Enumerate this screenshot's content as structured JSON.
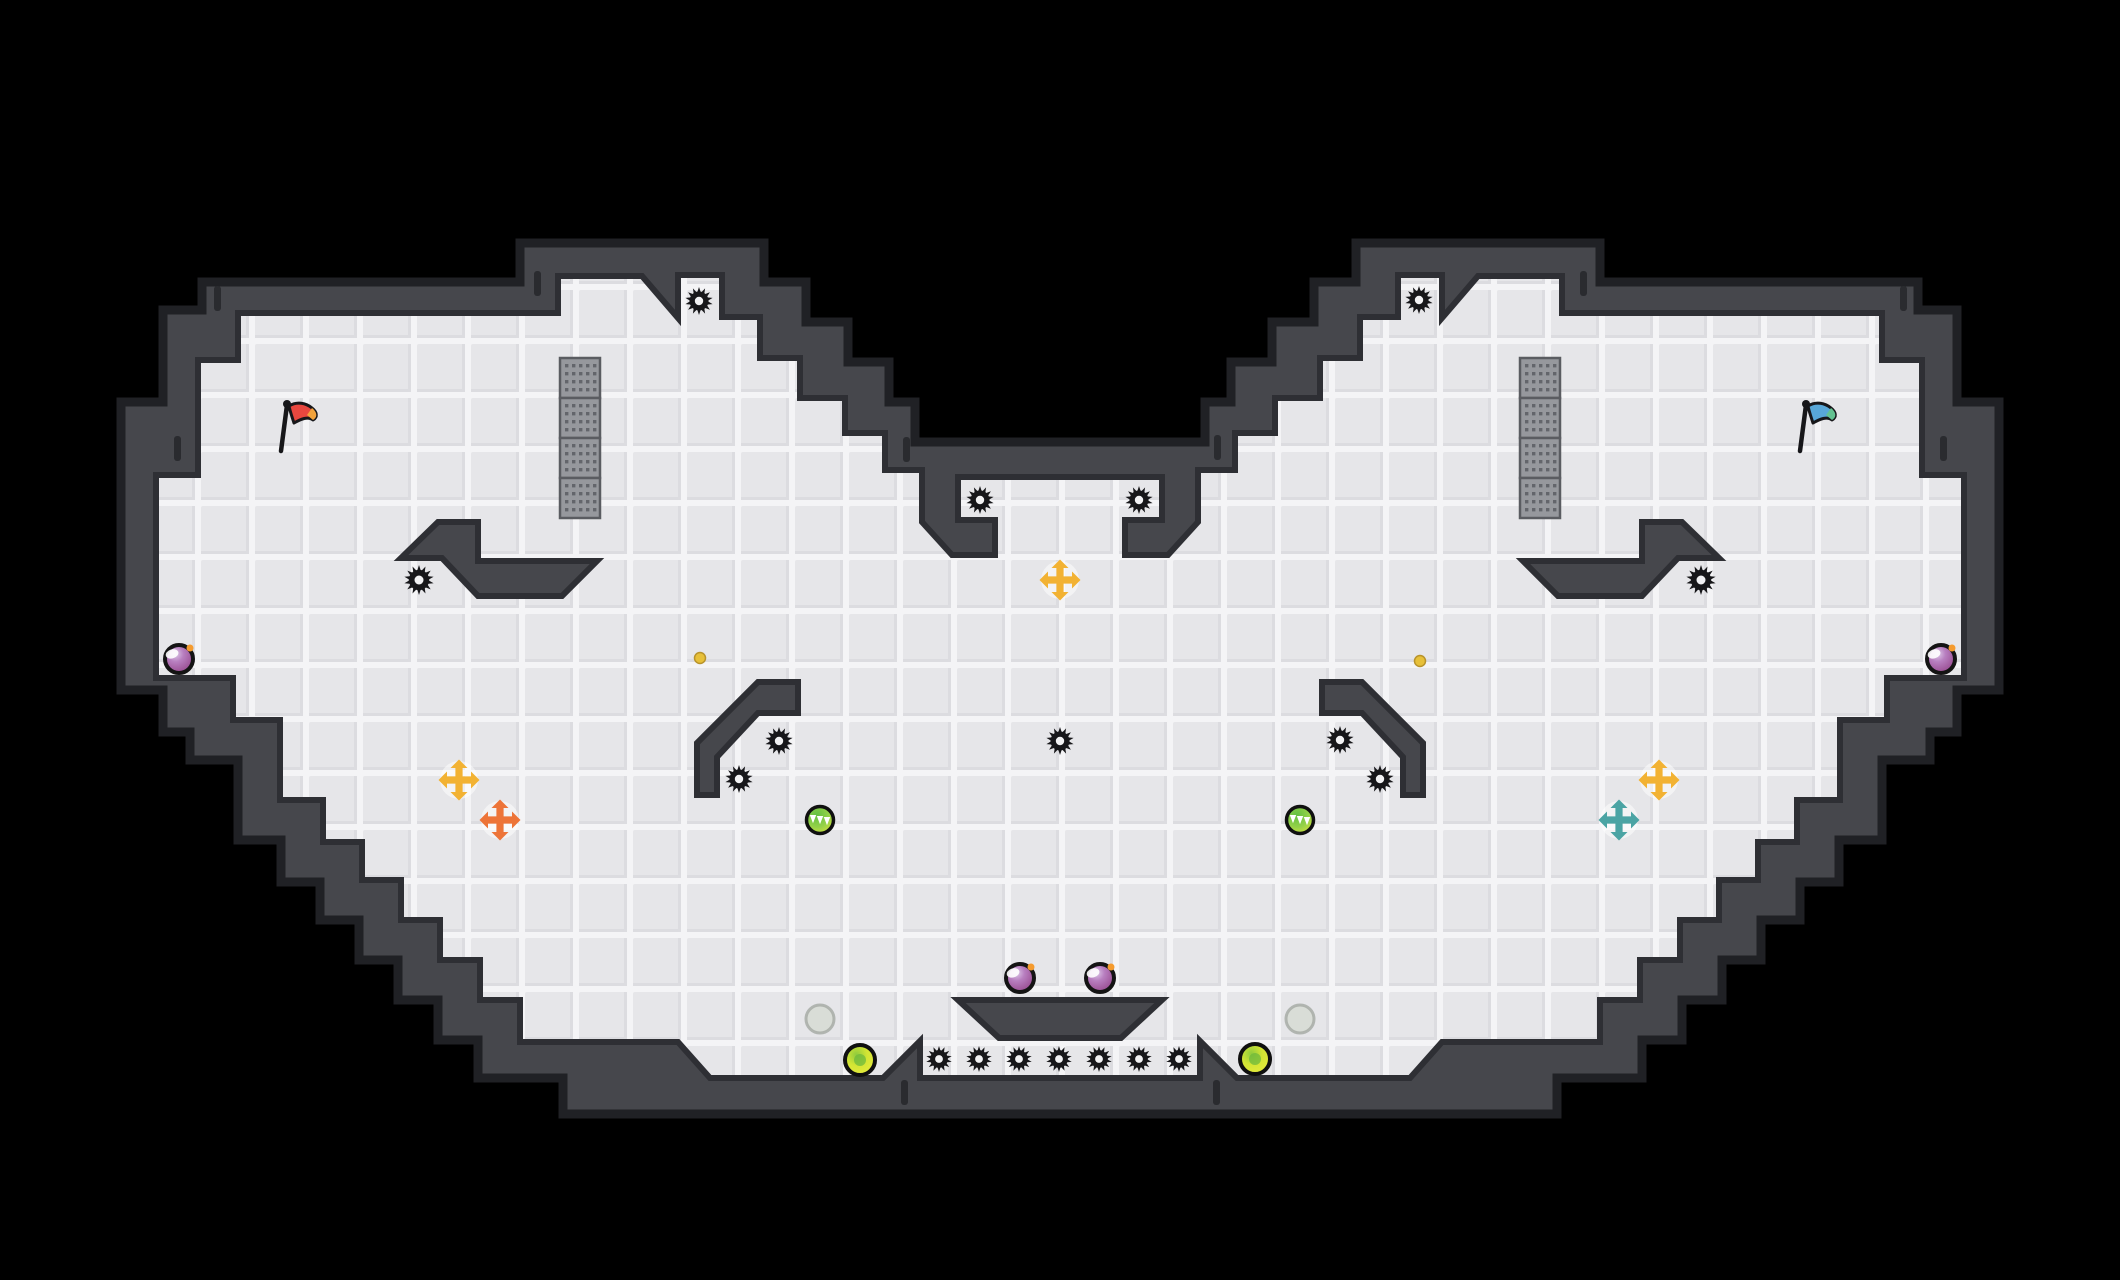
{
  "scene": {
    "width": 2120,
    "height": 1280,
    "background": "#000000"
  },
  "palette": {
    "wall": "#46474c",
    "wall_rim": "#202125",
    "wall_shadow": "#2e2f34",
    "tile": "#e6e6e9",
    "tile_groove": "#f4f4f6",
    "tile_shade": "#dcdce0",
    "gear": "#17171a",
    "gear_hole": "#f2f2f4",
    "grate_base": "#96989d",
    "grate_dot": "#63656b",
    "grate_border": "#5a5c61",
    "tick": "#2a2b2f"
  },
  "level": {
    "outer_wall_polygon": [
      [
        202,
        282
      ],
      [
        520,
        282
      ],
      [
        520,
        243
      ],
      [
        764,
        243
      ],
      [
        764,
        282
      ],
      [
        806,
        282
      ],
      [
        806,
        322
      ],
      [
        848,
        322
      ],
      [
        848,
        362
      ],
      [
        889,
        362
      ],
      [
        889,
        402
      ],
      [
        915,
        402
      ],
      [
        915,
        442
      ],
      [
        1205,
        442
      ],
      [
        1205,
        402
      ],
      [
        1231,
        402
      ],
      [
        1231,
        362
      ],
      [
        1272,
        362
      ],
      [
        1272,
        322
      ],
      [
        1314,
        322
      ],
      [
        1314,
        282
      ],
      [
        1356,
        282
      ],
      [
        1356,
        243
      ],
      [
        1600,
        243
      ],
      [
        1600,
        282
      ],
      [
        1918,
        282
      ],
      [
        1918,
        310
      ],
      [
        1957,
        310
      ],
      [
        1957,
        402
      ],
      [
        1999,
        402
      ],
      [
        1999,
        690
      ],
      [
        1957,
        690
      ],
      [
        1957,
        732
      ],
      [
        1930,
        732
      ],
      [
        1930,
        760
      ],
      [
        1882,
        760
      ],
      [
        1882,
        840
      ],
      [
        1839,
        840
      ],
      [
        1839,
        882
      ],
      [
        1800,
        882
      ],
      [
        1800,
        920
      ],
      [
        1761,
        920
      ],
      [
        1761,
        960
      ],
      [
        1722,
        960
      ],
      [
        1722,
        1000
      ],
      [
        1682,
        1000
      ],
      [
        1682,
        1040
      ],
      [
        1642,
        1040
      ],
      [
        1642,
        1078
      ],
      [
        1557,
        1078
      ],
      [
        1557,
        1114
      ],
      [
        563,
        1114
      ],
      [
        563,
        1078
      ],
      [
        478,
        1078
      ],
      [
        478,
        1040
      ],
      [
        438,
        1040
      ],
      [
        438,
        1000
      ],
      [
        398,
        1000
      ],
      [
        398,
        960
      ],
      [
        359,
        960
      ],
      [
        359,
        920
      ],
      [
        320,
        920
      ],
      [
        320,
        882
      ],
      [
        281,
        882
      ],
      [
        281,
        840
      ],
      [
        238,
        840
      ],
      [
        238,
        760
      ],
      [
        190,
        760
      ],
      [
        190,
        732
      ],
      [
        163,
        732
      ],
      [
        163,
        690
      ],
      [
        121,
        690
      ],
      [
        121,
        402
      ],
      [
        163,
        402
      ],
      [
        163,
        310
      ],
      [
        202,
        310
      ]
    ],
    "floor_polygon": [
      [
        238,
        313
      ],
      [
        558,
        313
      ],
      [
        558,
        276
      ],
      [
        642,
        276
      ],
      [
        678,
        318
      ],
      [
        678,
        275
      ],
      [
        722,
        275
      ],
      [
        722,
        317
      ],
      [
        760,
        317
      ],
      [
        760,
        358
      ],
      [
        800,
        358
      ],
      [
        800,
        398
      ],
      [
        845,
        398
      ],
      [
        845,
        433
      ],
      [
        885,
        433
      ],
      [
        885,
        470
      ],
      [
        922,
        470
      ],
      [
        922,
        522
      ],
      [
        952,
        555
      ],
      [
        995,
        555
      ],
      [
        995,
        520
      ],
      [
        958,
        520
      ],
      [
        958,
        477
      ],
      [
        1162,
        477
      ],
      [
        1162,
        520
      ],
      [
        1125,
        520
      ],
      [
        1125,
        555
      ],
      [
        1168,
        555
      ],
      [
        1198,
        522
      ],
      [
        1198,
        470
      ],
      [
        1235,
        470
      ],
      [
        1235,
        433
      ],
      [
        1275,
        433
      ],
      [
        1275,
        398
      ],
      [
        1320,
        398
      ],
      [
        1320,
        358
      ],
      [
        1360,
        358
      ],
      [
        1360,
        317
      ],
      [
        1398,
        317
      ],
      [
        1398,
        275
      ],
      [
        1442,
        275
      ],
      [
        1442,
        318
      ],
      [
        1478,
        276
      ],
      [
        1562,
        276
      ],
      [
        1562,
        313
      ],
      [
        1882,
        313
      ],
      [
        1882,
        360
      ],
      [
        1922,
        360
      ],
      [
        1922,
        475
      ],
      [
        1964,
        475
      ],
      [
        1964,
        678
      ],
      [
        1887,
        678
      ],
      [
        1887,
        720
      ],
      [
        1840,
        720
      ],
      [
        1840,
        800
      ],
      [
        1797,
        800
      ],
      [
        1797,
        842
      ],
      [
        1758,
        842
      ],
      [
        1758,
        880
      ],
      [
        1719,
        880
      ],
      [
        1719,
        920
      ],
      [
        1680,
        920
      ],
      [
        1680,
        960
      ],
      [
        1640,
        960
      ],
      [
        1640,
        1000
      ],
      [
        1600,
        1000
      ],
      [
        1600,
        1042
      ],
      [
        1442,
        1042
      ],
      [
        1410,
        1078
      ],
      [
        1237,
        1078
      ],
      [
        1200,
        1041
      ],
      [
        1200,
        1078
      ],
      [
        920,
        1078
      ],
      [
        920,
        1041
      ],
      [
        883,
        1078
      ],
      [
        710,
        1078
      ],
      [
        678,
        1042
      ],
      [
        520,
        1042
      ],
      [
        520,
        1000
      ],
      [
        480,
        1000
      ],
      [
        480,
        960
      ],
      [
        440,
        960
      ],
      [
        440,
        920
      ],
      [
        401,
        920
      ],
      [
        401,
        880
      ],
      [
        362,
        880
      ],
      [
        362,
        842
      ],
      [
        323,
        842
      ],
      [
        323,
        800
      ],
      [
        280,
        800
      ],
      [
        280,
        720
      ],
      [
        233,
        720
      ],
      [
        233,
        678
      ],
      [
        156,
        678
      ],
      [
        156,
        475
      ],
      [
        198,
        475
      ],
      [
        198,
        360
      ],
      [
        238,
        360
      ]
    ],
    "platforms": [
      {
        "name": "chevron-platform-left",
        "points": [
          [
            401,
            558
          ],
          [
            438,
            522
          ],
          [
            478,
            522
          ],
          [
            478,
            561
          ],
          [
            597,
            561
          ],
          [
            562,
            596
          ],
          [
            478,
            596
          ],
          [
            442,
            558
          ]
        ]
      },
      {
        "name": "chevron-platform-right",
        "points": [
          [
            1719,
            558
          ],
          [
            1682,
            522
          ],
          [
            1642,
            522
          ],
          [
            1642,
            561
          ],
          [
            1523,
            561
          ],
          [
            1558,
            596
          ],
          [
            1642,
            596
          ],
          [
            1678,
            558
          ]
        ]
      },
      {
        "name": "hook-platform-left",
        "points": [
          [
            798,
            682
          ],
          [
            758,
            682
          ],
          [
            697,
            743
          ],
          [
            697,
            795
          ],
          [
            717,
            795
          ],
          [
            717,
            757
          ],
          [
            758,
            713
          ],
          [
            798,
            713
          ]
        ]
      },
      {
        "name": "hook-platform-right",
        "points": [
          [
            1322,
            682
          ],
          [
            1362,
            682
          ],
          [
            1423,
            743
          ],
          [
            1423,
            795
          ],
          [
            1403,
            795
          ],
          [
            1403,
            757
          ],
          [
            1362,
            713
          ],
          [
            1322,
            713
          ]
        ]
      },
      {
        "name": "center-trapezoid-platform",
        "points": [
          [
            958,
            1000
          ],
          [
            1162,
            1000
          ],
          [
            1121,
            1038
          ],
          [
            999,
            1038
          ]
        ]
      }
    ],
    "grates": [
      {
        "name": "grate-column-left",
        "x": 560,
        "y": 358,
        "block": 40,
        "blocks": 4
      },
      {
        "name": "grate-column-right",
        "x": 1520,
        "y": 358,
        "block": 40,
        "blocks": 4
      }
    ],
    "wall_ticks": [
      [
        214,
        286
      ],
      [
        174,
        436
      ],
      [
        534,
        271
      ],
      [
        1580,
        271
      ],
      [
        903,
        437
      ],
      [
        1214,
        435
      ],
      [
        1900,
        286
      ],
      [
        1940,
        436
      ],
      [
        901,
        1080
      ],
      [
        1213,
        1080
      ]
    ]
  },
  "entities": {
    "flags": [
      {
        "name": "red-flag",
        "x": 287,
        "y": 404,
        "cloth": "#e8473f",
        "tip": "#f2a33c"
      },
      {
        "name": "blue-flag",
        "x": 1806,
        "y": 404,
        "cloth": "#58a7d8",
        "tip": "#63c291"
      }
    ],
    "gears": [
      {
        "x": 699,
        "y": 301,
        "r": 14
      },
      {
        "x": 1419,
        "y": 300,
        "r": 14
      },
      {
        "x": 980,
        "y": 500,
        "r": 14
      },
      {
        "x": 1139,
        "y": 500,
        "r": 14
      },
      {
        "x": 419,
        "y": 580,
        "r": 15
      },
      {
        "x": 1701,
        "y": 580,
        "r": 15
      },
      {
        "x": 779,
        "y": 741,
        "r": 14
      },
      {
        "x": 739,
        "y": 779,
        "r": 14
      },
      {
        "x": 1340,
        "y": 740,
        "r": 14
      },
      {
        "x": 1380,
        "y": 779,
        "r": 14
      },
      {
        "x": 1060,
        "y": 741,
        "r": 14
      },
      {
        "x": 939,
        "y": 1059,
        "r": 13
      },
      {
        "x": 979,
        "y": 1059,
        "r": 13
      },
      {
        "x": 1019,
        "y": 1059,
        "r": 13
      },
      {
        "x": 1059,
        "y": 1059,
        "r": 13
      },
      {
        "x": 1099,
        "y": 1059,
        "r": 13
      },
      {
        "x": 1139,
        "y": 1059,
        "r": 13
      },
      {
        "x": 1179,
        "y": 1059,
        "r": 13
      }
    ],
    "purple_orbs": [
      {
        "x": 179,
        "y": 659
      },
      {
        "x": 1941,
        "y": 659
      },
      {
        "x": 1020,
        "y": 978
      },
      {
        "x": 1100,
        "y": 978
      }
    ],
    "green_orbs": [
      {
        "x": 820,
        "y": 820
      },
      {
        "x": 1300,
        "y": 820
      }
    ],
    "lime_orbs": [
      {
        "x": 860,
        "y": 1060
      },
      {
        "x": 1255,
        "y": 1059
      }
    ],
    "ghost_orbs": [
      {
        "x": 820,
        "y": 1019
      },
      {
        "x": 1300,
        "y": 1019
      }
    ],
    "small_dots": [
      {
        "x": 700,
        "y": 658,
        "color": "#e7c039"
      },
      {
        "x": 1420,
        "y": 661,
        "color": "#e7c039"
      }
    ],
    "arrows": [
      {
        "name": "boost-arrow-gold-center",
        "x": 1060,
        "y": 580,
        "color": "#f2b233"
      },
      {
        "name": "boost-arrow-gold-left",
        "x": 459,
        "y": 780,
        "color": "#f2b233"
      },
      {
        "name": "boost-arrow-orange-left",
        "x": 500,
        "y": 820,
        "color": "#ed7438"
      },
      {
        "name": "boost-arrow-gold-right",
        "x": 1659,
        "y": 780,
        "color": "#f2b233"
      },
      {
        "name": "boost-arrow-teal-right",
        "x": 1619,
        "y": 820,
        "color": "#4ba4a4"
      }
    ]
  }
}
